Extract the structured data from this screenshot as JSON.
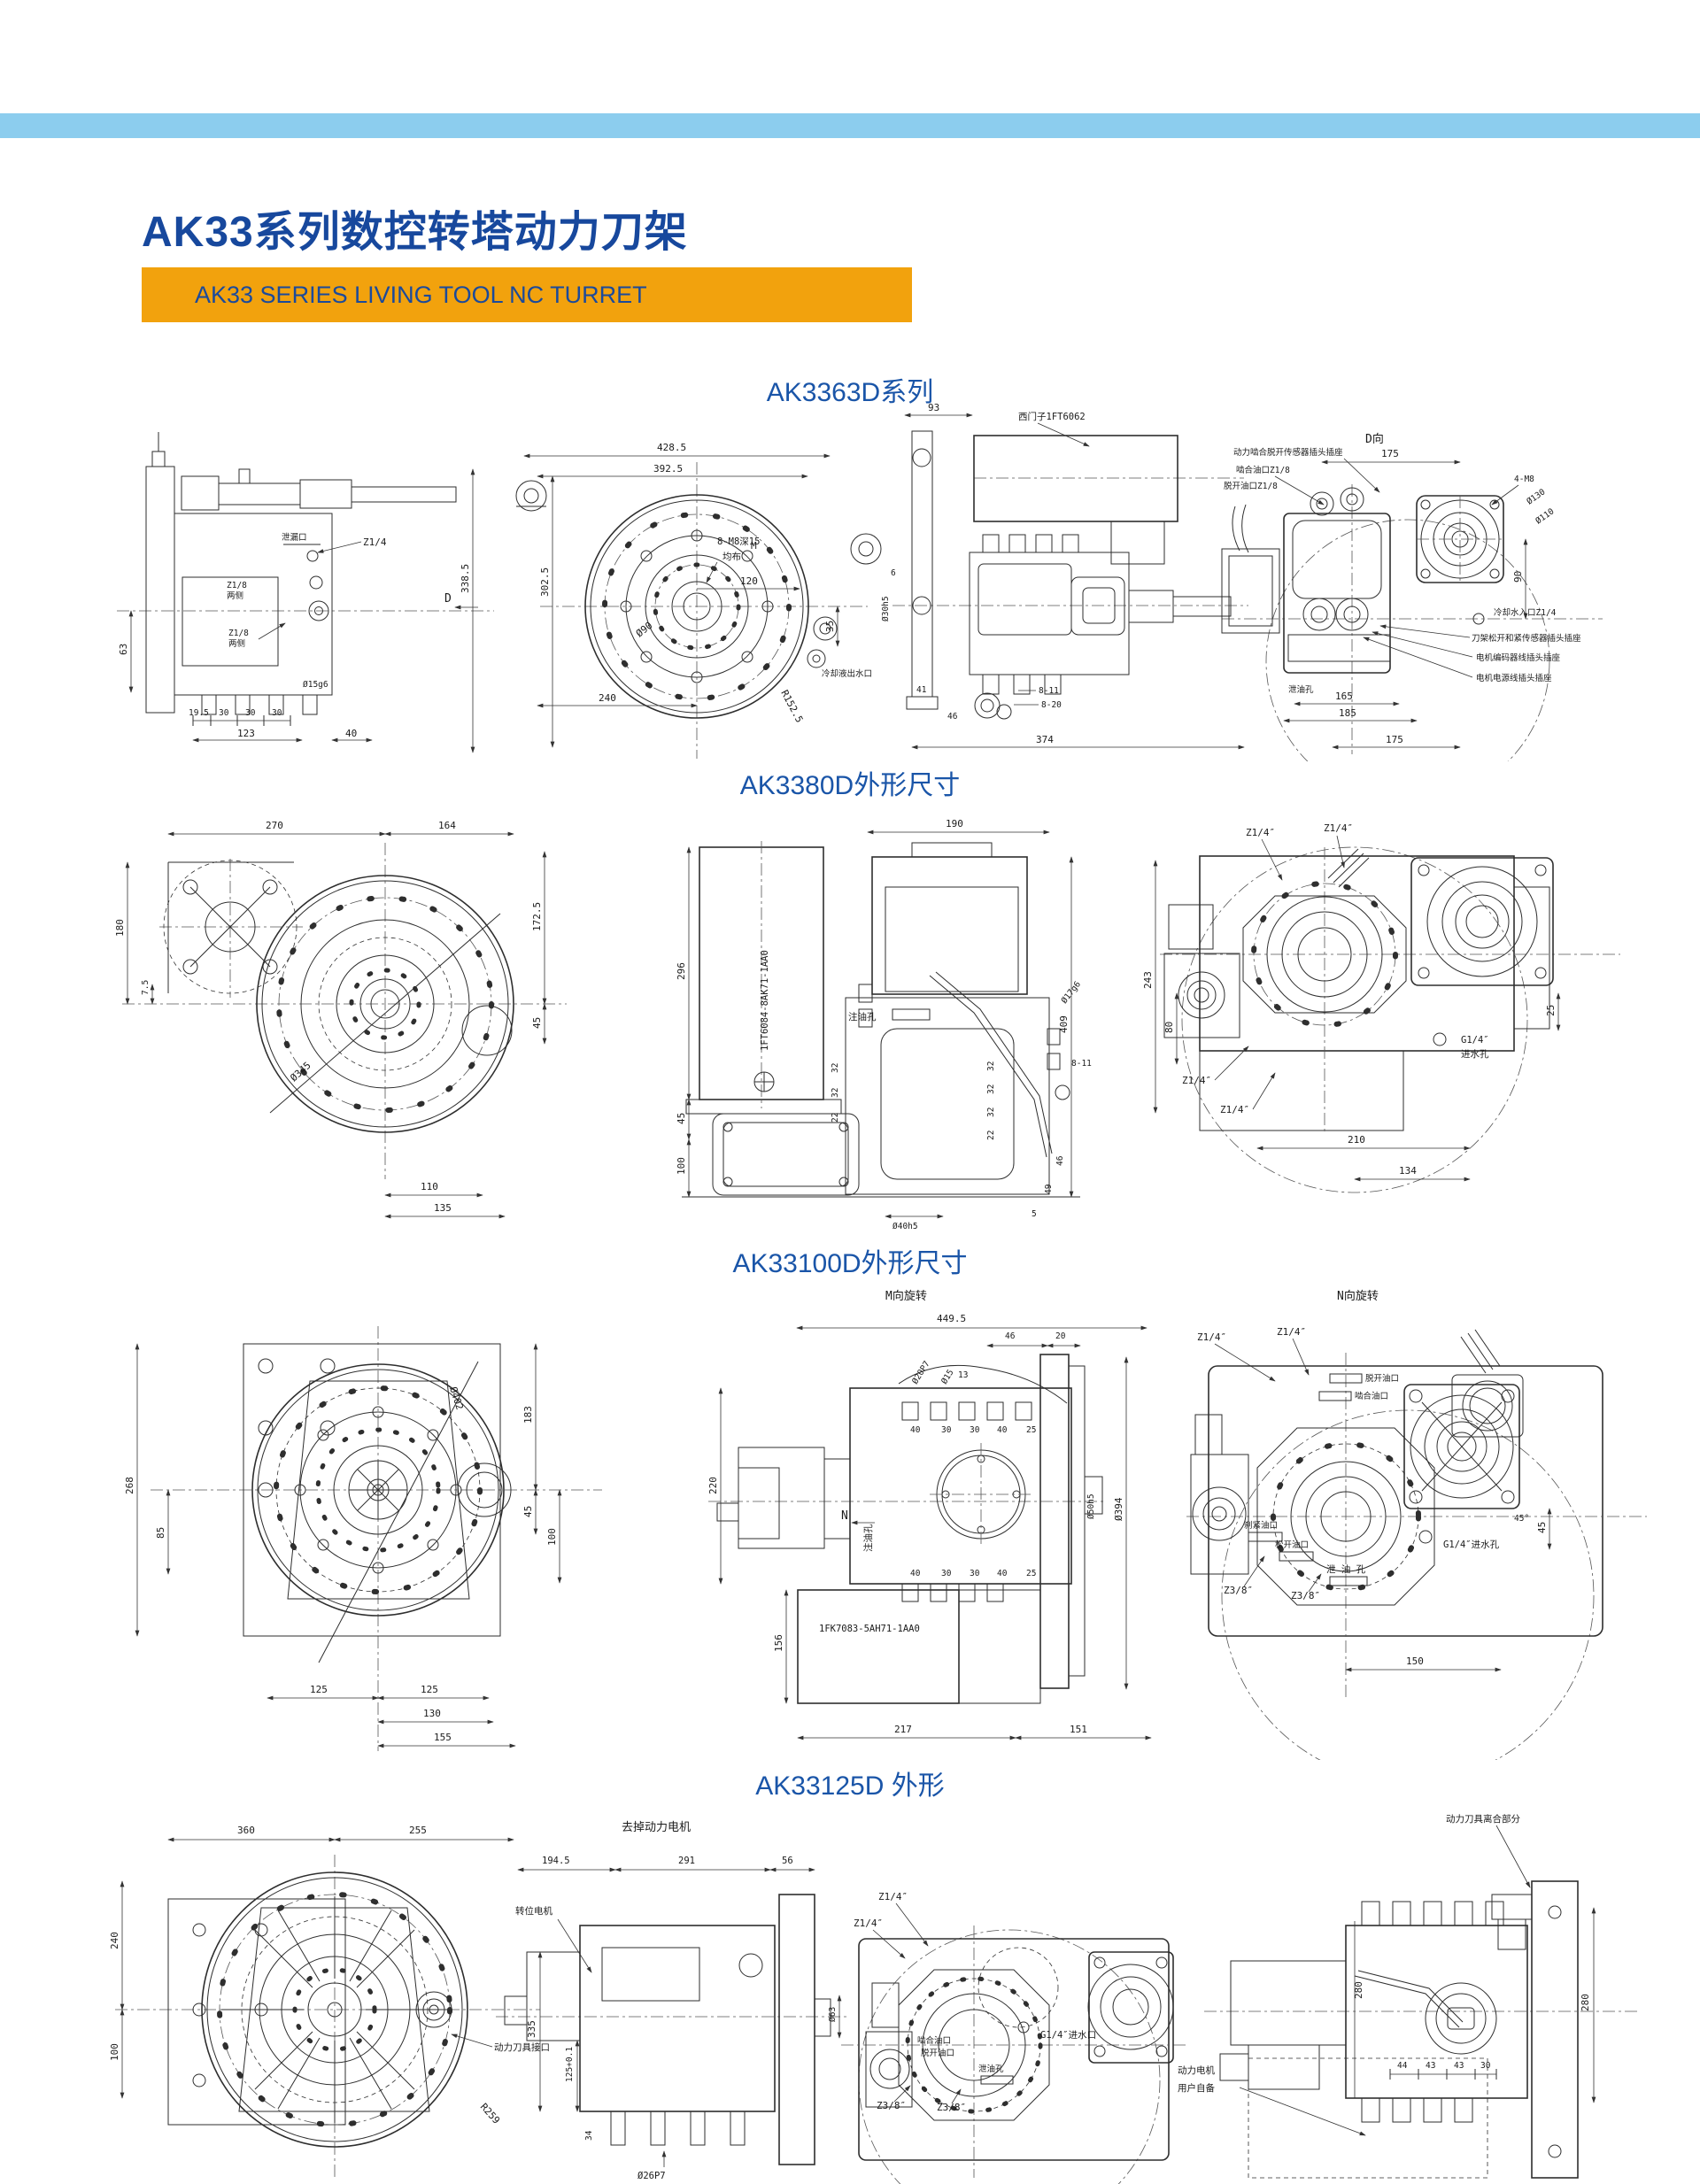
{
  "page": {
    "title": "AK33系列数控转塔动力刀架",
    "subtitle": "AK33 SERIES LIVING TOOL NC TURRET",
    "colors": {
      "band": "#8CCDEE",
      "banner": "#F2A20D",
      "title_blue": "#17489D",
      "section_blue": "#1A55A8"
    }
  },
  "sections": [
    {
      "title": "AK3363D系列",
      "views": [
        {
          "name": "left-side-view",
          "labels": {
            "xielou": "泄漏口",
            "z14": "Z1/4",
            "z18a": "Z1/8",
            "lca": "两侧",
            "z18b": "Z1/8",
            "lcb": "两侧",
            "d15g6": "Ø15g6",
            "d63": "63",
            "d195": "19.5",
            "d30a": "30",
            "d30b": "30",
            "d30c": "30",
            "d123": "123",
            "d40": "40"
          }
        },
        {
          "name": "front-view",
          "labels": {
            "d4285": "428.5",
            "d3925": "392.5",
            "d3385": "338.5",
            "d3025": "302.5",
            "d240": "240",
            "m8": "8-M8深15",
            "junbu": "均布",
            "d120": "120",
            "d90": "Ø90",
            "r1525": "R152.5",
            "d35": "35",
            "cool": "冷却液出水口",
            "dv": "D",
            "m": "M"
          }
        },
        {
          "name": "right-side-view",
          "labels": {
            "d93": "93",
            "motor": "西门子1FT6062",
            "d6": "6",
            "d30h5": "Ø30h5",
            "d41": "41",
            "d46": "46",
            "d811": "8-11",
            "d820": "8-20",
            "d374": "374"
          }
        },
        {
          "name": "rear-view",
          "labels": {
            "dxiang": "D向",
            "sensor": "动力啮合脱开传感器插头插座",
            "niehe": "啮合油口Z1/8",
            "tuokai": "脱开油口Z1/8",
            "d175t": "175",
            "m8": "4-M8",
            "d130": "Ø130",
            "d110": "Ø110",
            "d90": "90",
            "coolin": "冷却水入口Z1/4",
            "plug1": "刀架松开和紧传感器插头插座",
            "plug2": "电机编码器线插头插座",
            "plug3": "电机电源线插头插座",
            "xieyou": "泄油孔",
            "d165": "165",
            "d185": "185",
            "d175b": "175"
          }
        }
      ]
    },
    {
      "title": "AK3380D外形尺寸",
      "views": [
        {
          "name": "front-view",
          "labels": {
            "d270": "270",
            "d164": "164",
            "d180": "180",
            "d75": "7.5",
            "d1725": "172.5",
            "d45": "45",
            "d345": "Ø345",
            "d110": "110",
            "d135": "135"
          }
        },
        {
          "name": "side-view",
          "labels": {
            "d190": "190",
            "d296": "296",
            "d45": "45",
            "d100": "100",
            "motor": "1FT6084-8AK71-1AA0",
            "zhuyou": "注油孔",
            "d17g6": "Ø17g6",
            "d811": "8-11",
            "d409": "409",
            "l1": "32",
            "l2": "32",
            "l3": "22",
            "r1": "32",
            "r2": "32",
            "r3": "32",
            "r4": "22",
            "d46": "46",
            "d49": "49",
            "d5": "5",
            "d40h5": "Ø40h5"
          }
        },
        {
          "name": "top-view",
          "labels": {
            "z14a": "Z1/4″",
            "z14b": "Z1/4″",
            "z14c": "Z1/4″",
            "z14d": "Z1/4″",
            "d243": "243",
            "d80": "80",
            "d25": "25",
            "g14a": "G1/4″",
            "g14b": "进水孔",
            "d210": "210",
            "d134": "134"
          }
        }
      ]
    },
    {
      "title": "AK33100D外形尺寸",
      "views": [
        {
          "name": "front-view",
          "labels": {
            "d402": "Ø402",
            "d268": "268",
            "d85": "85",
            "d183": "183",
            "d45": "45",
            "d100": "100",
            "d125a": "125",
            "d125b": "125",
            "d130": "130",
            "d155": "155"
          }
        },
        {
          "name": "side-view",
          "labels": {
            "mx": "M向旋转",
            "d4495": "449.5",
            "d46": "46",
            "d20": "20",
            "d20p7": "Ø20P7",
            "d15": "Ø15",
            "d13": "13",
            "t1": "40",
            "t2": "30",
            "t3": "30",
            "t4": "40",
            "t5": "25",
            "b1": "40",
            "b2": "30",
            "b3": "30",
            "b4": "40",
            "b5": "25",
            "d220": "220",
            "n": "N",
            "zhuyou": "注油孔",
            "d50h5": "Ø50h5",
            "d394": "Ø394",
            "motor": "1FK7083-5AH71-1AA0",
            "d156": "156",
            "d217": "217",
            "d151": "151"
          }
        },
        {
          "name": "top-view",
          "labels": {
            "nx": "N向旋转",
            "z14a": "Z1/4″",
            "z14b": "Z1/4″",
            "tuokai": "脱开油口",
            "niehe": "啮合油口",
            "deg45": "45°",
            "d45": "45",
            "g14": "G1/4″进水孔",
            "shajin": "刹紧油口",
            "songkai": "松开油口",
            "xieyou": "泄 油 孔",
            "z38a": "Z3/8″",
            "z38b": "Z3/8″",
            "d150": "150"
          }
        }
      ]
    },
    {
      "title": "AK33125D 外形",
      "views": [
        {
          "name": "front-view",
          "labels": {
            "d360": "360",
            "d255": "255",
            "d240": "240",
            "d100": "100",
            "r259": "R259",
            "jiekou": "动力刀具接口"
          }
        },
        {
          "name": "side-view-no-motor",
          "labels": {
            "top": "去掉动力电机",
            "d1945": "194.5",
            "d291": "291",
            "d56": "56",
            "zhuanwei": "转位电机",
            "d335": "335",
            "d125": "125+0.1",
            "d34": "34",
            "d26p7": "Ø26P7",
            "d63": "Ø63"
          }
        },
        {
          "name": "top-view",
          "labels": {
            "z14a": "Z1/4″",
            "z14b": "Z1/4″",
            "g14": "G1/4″进水口",
            "niehe": "啮合油口",
            "tuokai": "脱开油口",
            "xieyou": "泄油孔",
            "z38a": "Z3/8″",
            "z38b": "Z3/8″"
          }
        },
        {
          "name": "side-view-with-motor",
          "labels": {
            "top": "动力刀具离合部分",
            "d280a": "280",
            "d280b": "280",
            "d44": "44",
            "d43a": "43",
            "d43b": "43",
            "d30": "30",
            "m1": "动力电机",
            "m2": "用户自备"
          }
        }
      ]
    }
  ]
}
